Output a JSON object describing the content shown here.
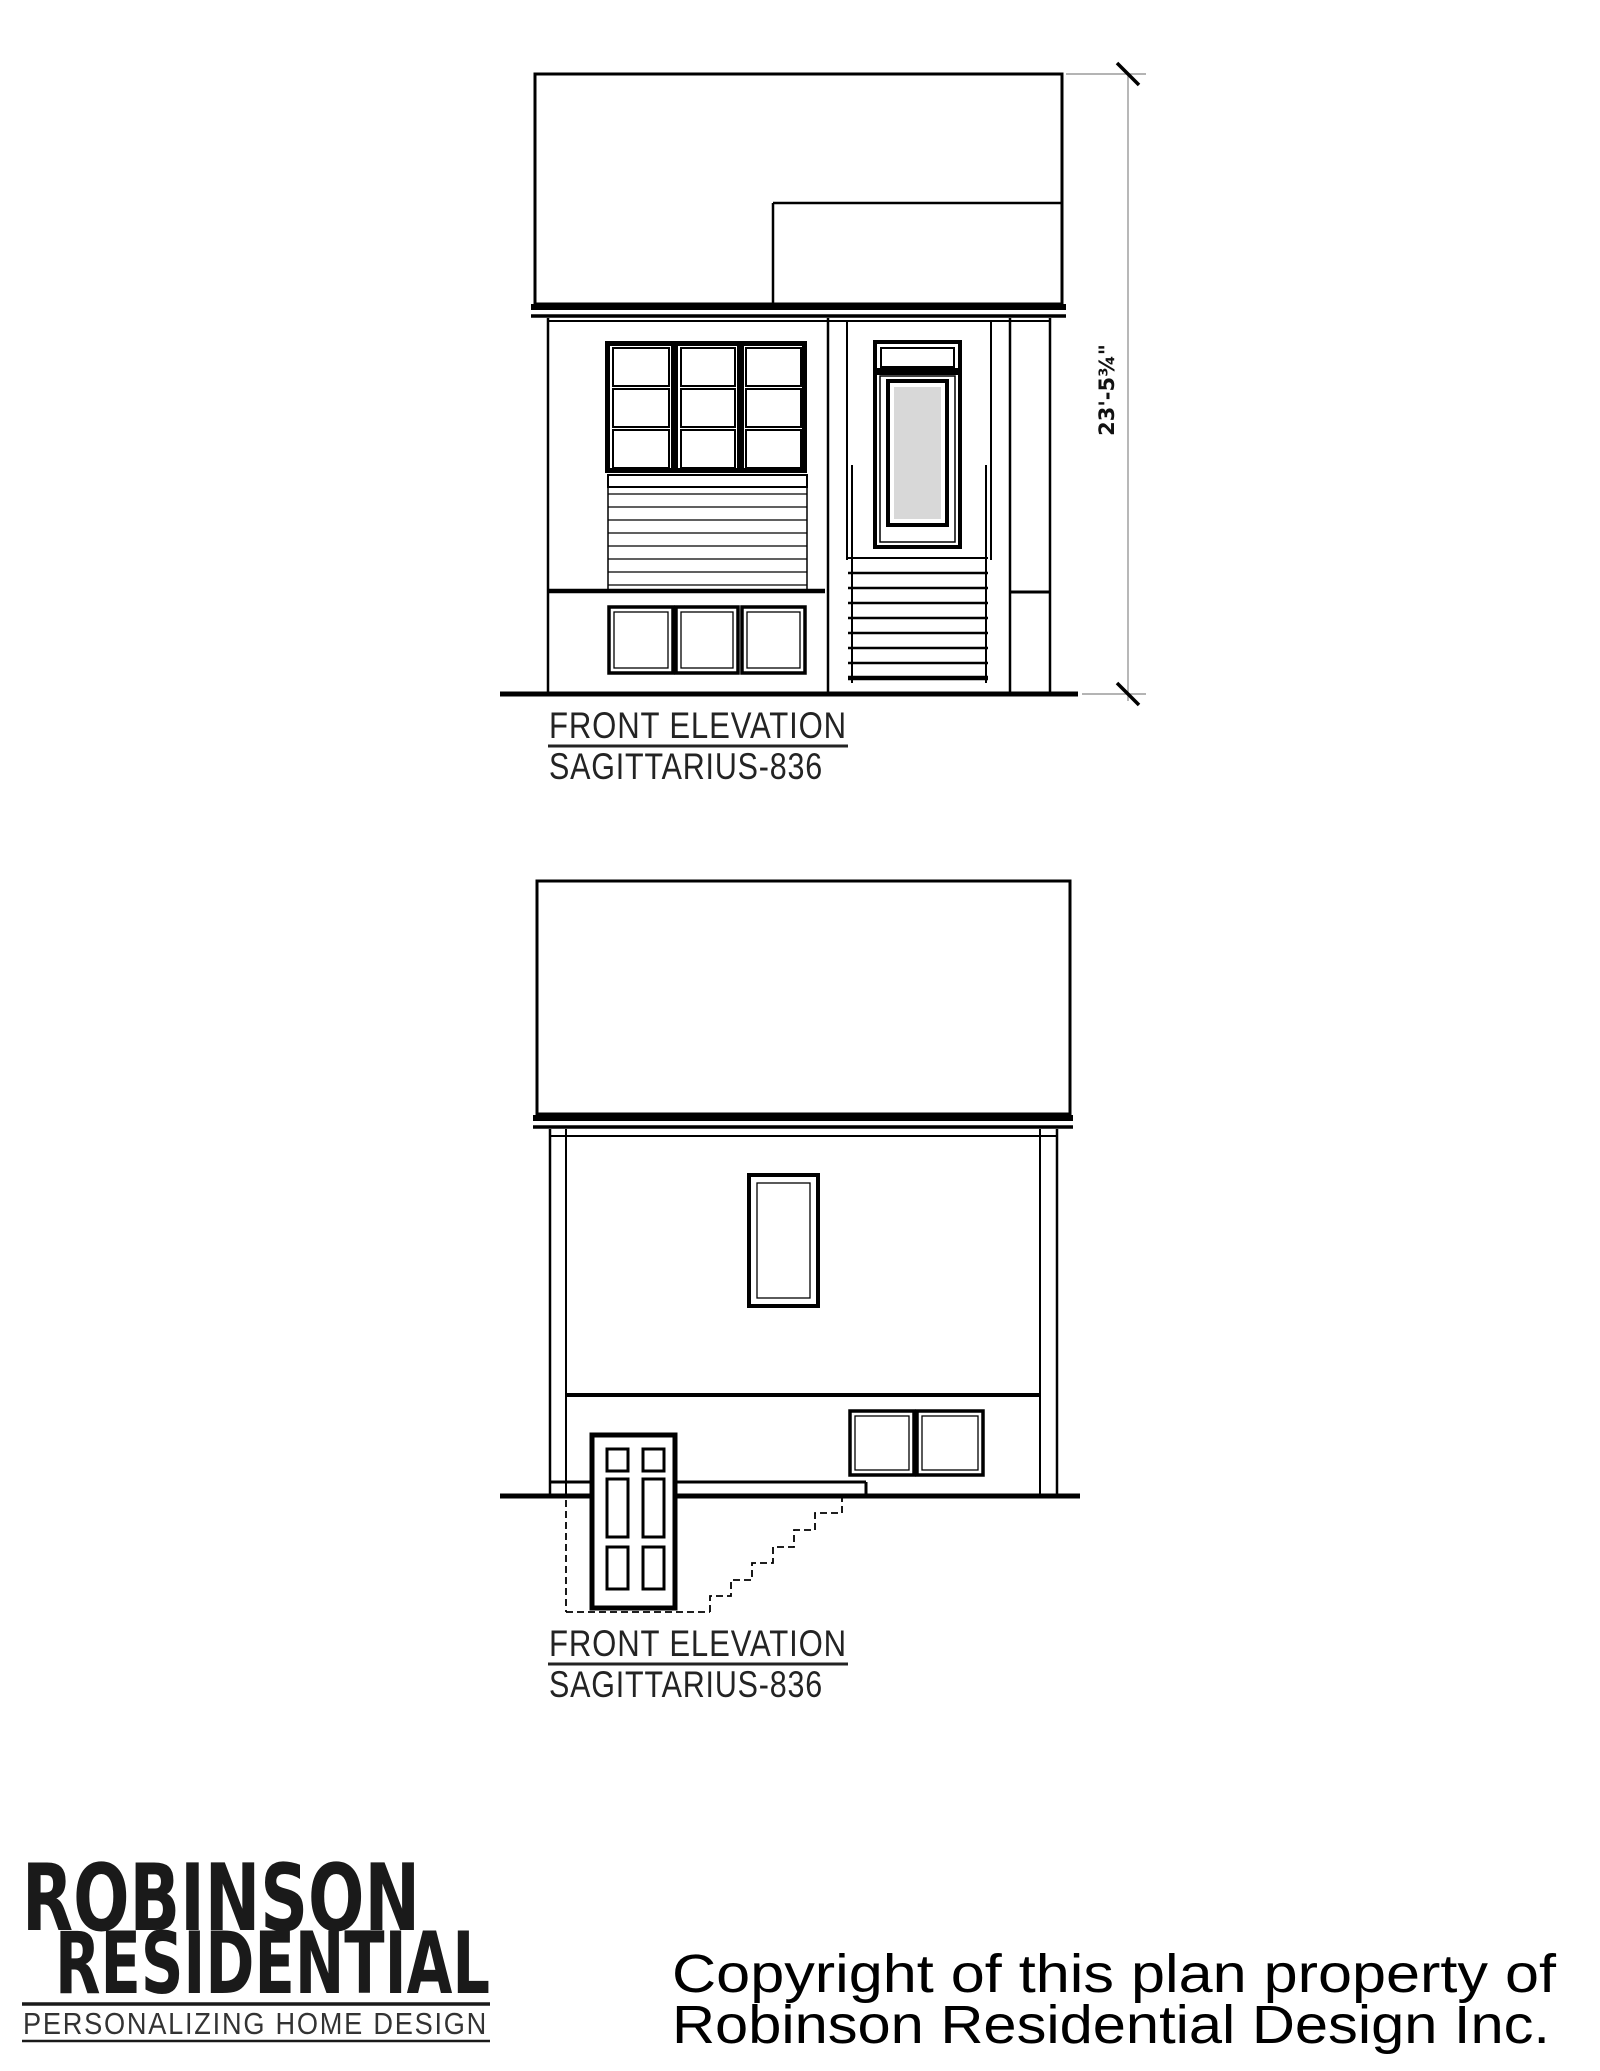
{
  "elevation_top": {
    "title": "FRONT ELEVATION",
    "subtitle": "SAGITTARIUS-836",
    "dimension_label": "23'-5¾\""
  },
  "elevation_bottom": {
    "title": "FRONT ELEVATION",
    "subtitle": "SAGITTARIUS-836"
  },
  "logo": {
    "line1": "ROBINSON",
    "line2": "RESIDENTIAL",
    "tagline": "PERSONALIZING HOME DESIGN"
  },
  "copyright": {
    "line1": "Copyright of this plan property of",
    "line2": "Robinson Residential Design Inc.",
    "color": "#e2201d"
  },
  "colors": {
    "line": "#000000",
    "glass": "#d8d8d8",
    "dimension_line": "#888888"
  }
}
